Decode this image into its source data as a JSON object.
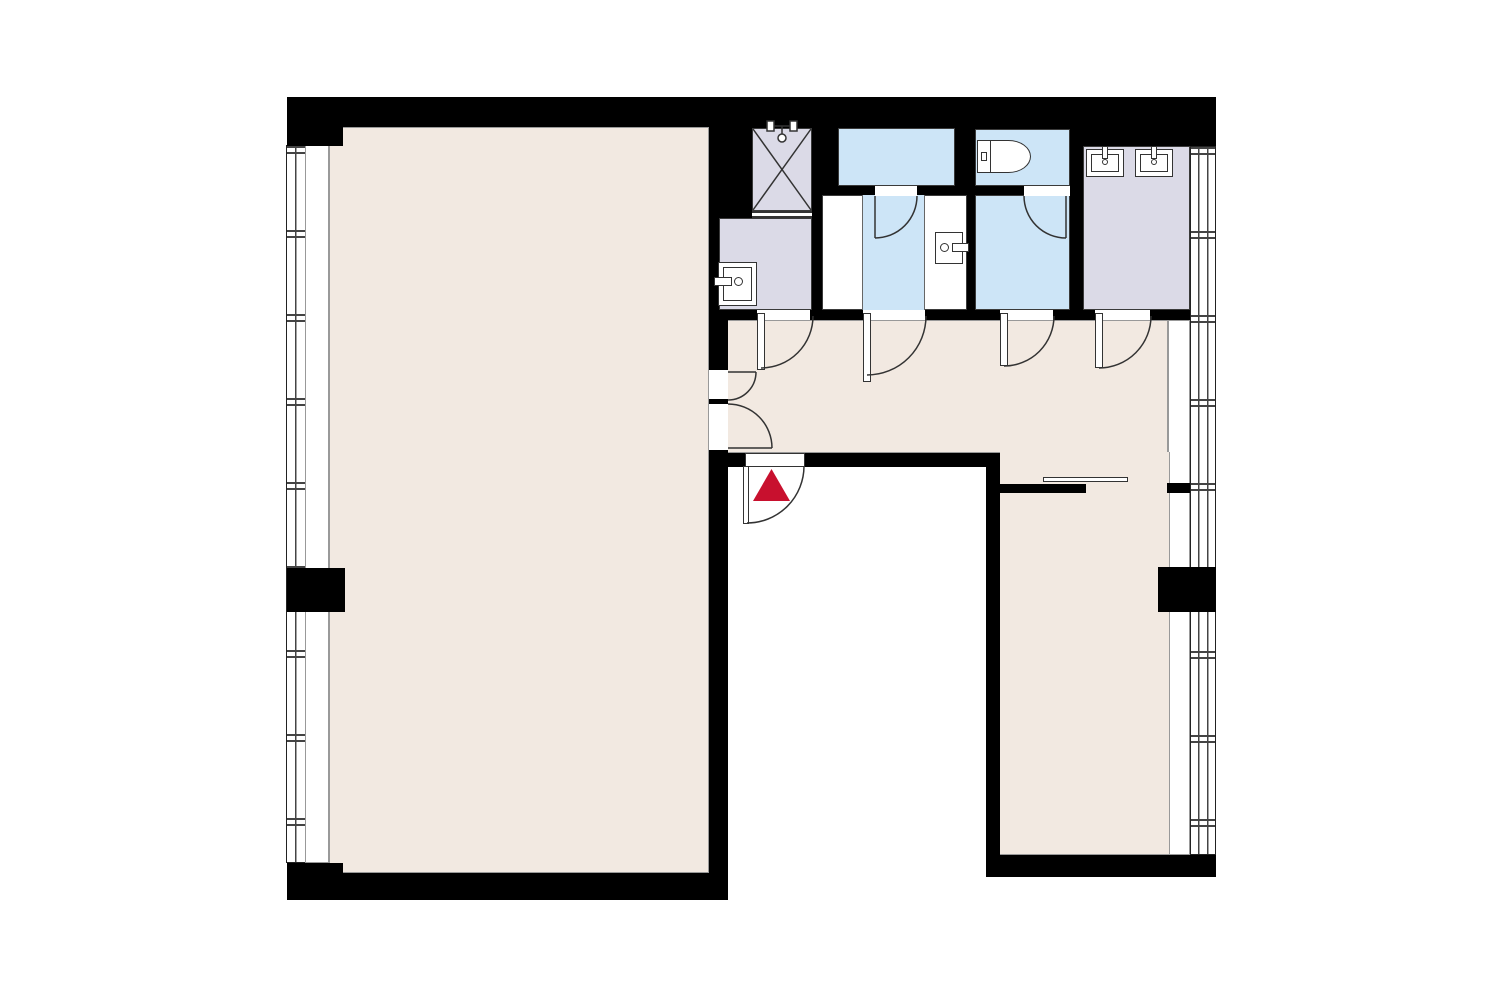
{
  "meta": {
    "type": "architectural-floor-plan",
    "description": "U-shaped apartment floor plan with central entry courtyard at bottom, large room on left wing, sanitary block along top, second room on right wing",
    "visible_text": ""
  },
  "colors": {
    "wall": "#000000",
    "floor_beige": "#F2E9E1",
    "wet_area_blue": "#CDE5F7",
    "tile_lavender": "#DBDAE7",
    "exterior_white": "#FFFFFF",
    "line": "#333333",
    "entrance_marker_red": "#C8102E"
  },
  "rooms": [
    {
      "id": "main-room",
      "fill": "floor_beige",
      "position": "left-wing"
    },
    {
      "id": "corridor",
      "fill": "floor_beige",
      "position": "top-center"
    },
    {
      "id": "right-room",
      "fill": "floor_beige",
      "position": "right-wing"
    },
    {
      "id": "shower-stall",
      "fill": "tile_lavender",
      "position": "top, with X mark and shower head"
    },
    {
      "id": "utility-washroom",
      "fill": "tile_lavender",
      "position": "below shower, with washbasin"
    },
    {
      "id": "bathtub-room",
      "fill": "wet_area_blue",
      "position": "top-center"
    },
    {
      "id": "bath-anteroom",
      "fill": "wet_area_blue",
      "position": "below bathtub room"
    },
    {
      "id": "toilet-room",
      "fill": "wet_area_blue",
      "position": "top, with toilet"
    },
    {
      "id": "wc-anteroom",
      "fill": "wet_area_blue",
      "position": "below toilet room"
    },
    {
      "id": "powder-room",
      "fill": "tile_lavender",
      "position": "top-right, double vanity"
    },
    {
      "id": "courtyard",
      "fill": "exterior_white",
      "position": "bottom-center, outside unit"
    }
  ],
  "fixtures": [
    {
      "id": "shower-head-icon"
    },
    {
      "id": "washbasin-utility"
    },
    {
      "id": "washbasin-anteroom"
    },
    {
      "id": "toilet-icon"
    },
    {
      "id": "vanity-sink-1"
    },
    {
      "id": "vanity-sink-2"
    }
  ],
  "doors": [
    {
      "id": "corridor-door-1",
      "swing": "into corridor"
    },
    {
      "id": "corridor-door-2",
      "swing": "into corridor"
    },
    {
      "id": "corridor-door-3",
      "swing": "into corridor"
    },
    {
      "id": "corridor-door-4",
      "swing": "into corridor"
    },
    {
      "id": "double-door-main-room",
      "swing": "into corridor"
    },
    {
      "id": "bath-door",
      "swing": "into anteroom"
    },
    {
      "id": "wc-door",
      "swing": "into anteroom"
    },
    {
      "id": "sliding-door-right-room",
      "state": "half-open"
    },
    {
      "id": "entrance-door",
      "swing": "outward to courtyard"
    }
  ],
  "entrance": {
    "marker": "red-triangle",
    "direction": "up",
    "color": "#C8102E"
  },
  "windows": {
    "left_band": "full-height strip of divided windows on left facade",
    "right_band": "full-height strip of divided windows on right facade",
    "columns": "black structural columns interrupt both window bands mid-height"
  }
}
